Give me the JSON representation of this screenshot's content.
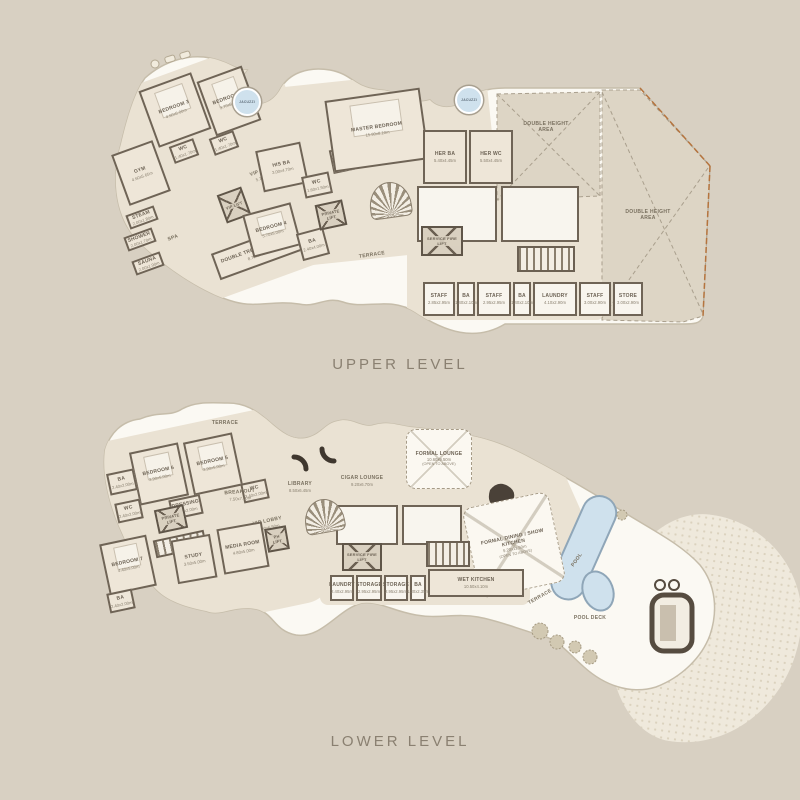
{
  "colors": {
    "background": "#d8d0c2",
    "plan_fill": "#fbf9f3",
    "floor_fill": "#eae2d3",
    "wall": "#6f6456",
    "pool": "#cfe1ed",
    "accent_rust": "#b5743e",
    "label_text": "#6d6355"
  },
  "plans": {
    "upper": {
      "caption": "UPPER LEVEL",
      "rooms": [
        {
          "name": "room-bedroom-3",
          "kind": "bedroom",
          "label": "BEDROOM 3",
          "dims": "4.60x5.00m",
          "box": [
            62,
            32,
            56,
            60,
            -20
          ]
        },
        {
          "name": "room-bedroom-2",
          "kind": "bedroom",
          "label": "BEDROOM 2",
          "dims": "3.70x5.00m",
          "box": [
            120,
            24,
            48,
            58,
            -20
          ]
        },
        {
          "name": "room-wc-bedroom3",
          "kind": "room",
          "label": "WC",
          "dims": "1.40x1.70m",
          "box": [
            86,
            94,
            26,
            18,
            -20
          ]
        },
        {
          "name": "room-wc-bedroom2",
          "kind": "room",
          "label": "WC",
          "dims": "1.40x1.70m",
          "box": [
            126,
            86,
            26,
            18,
            -20
          ]
        },
        {
          "name": "room-gym",
          "kind": "room",
          "label": "GYM",
          "dims": "4.60x5.65m",
          "box": [
            34,
            98,
            44,
            54,
            -20
          ]
        },
        {
          "name": "area-vip-lobby",
          "kind": "area",
          "label": "VIP LOBBY",
          "dims": "5.10x6.50m",
          "box": [
            150,
            112,
            60,
            26,
            -20
          ]
        },
        {
          "name": "room-vip-lift",
          "kind": "lift",
          "label": "VIP LIFT",
          "box": [
            136,
            142,
            26,
            30,
            -20
          ]
        },
        {
          "name": "room-steam",
          "kind": "room",
          "label": "STEAM",
          "dims": "2.00x1.80m",
          "box": [
            42,
            162,
            30,
            15,
            -20
          ]
        },
        {
          "name": "room-shower",
          "kind": "room",
          "label": "SHOWER",
          "dims": "2.00x1.70m",
          "box": [
            40,
            184,
            30,
            15,
            -20
          ]
        },
        {
          "name": "area-spa",
          "kind": "area",
          "label": "SPA",
          "box": [
            76,
            182,
            24,
            16,
            -20
          ]
        },
        {
          "name": "room-sauna",
          "kind": "room",
          "label": "SAUNA",
          "dims": "2.00x1.90m",
          "box": [
            48,
            208,
            30,
            15,
            -20
          ]
        },
        {
          "name": "room-double-treatment",
          "kind": "room",
          "label": "DOUBLE TREATMENT ROOM",
          "dims": "8.70x5.30m",
          "box": [
            128,
            190,
            88,
            28,
            -20
          ]
        },
        {
          "name": "room-bedroom-4",
          "kind": "bedroom",
          "label": "BEDROOM 4",
          "dims": "5.70x5.00m",
          "box": [
            162,
            160,
            50,
            44,
            -15
          ]
        },
        {
          "name": "room-ba-bedroom4",
          "kind": "room",
          "label": "BA",
          "dims": "2.40x4.00m",
          "box": [
            214,
            182,
            28,
            28,
            -15
          ]
        },
        {
          "name": "room-his-ba",
          "kind": "room",
          "label": "HIS BA",
          "dims": "3.00x4.70m",
          "box": [
            174,
            98,
            46,
            42,
            -12
          ]
        },
        {
          "name": "room-wc-master",
          "kind": "room",
          "label": "WC",
          "dims": "1.60x1.50m",
          "box": [
            218,
            126,
            28,
            22,
            -12
          ]
        },
        {
          "name": "room-safe",
          "kind": "room",
          "label": "SAFE",
          "dims": "1.20x1.90m",
          "box": [
            246,
            100,
            22,
            24,
            -12
          ]
        },
        {
          "name": "room-master-bedroom",
          "kind": "bedroom",
          "label": "MASTER BEDROOM",
          "dims": "15.90x8.10m",
          "box": [
            244,
            46,
            96,
            72,
            -8
          ]
        },
        {
          "name": "room-her-ba",
          "kind": "room",
          "label": "HER BA",
          "dims": "5.40x4.45m",
          "box": [
            338,
            82,
            44,
            54,
            0
          ]
        },
        {
          "name": "room-her-wc",
          "kind": "room",
          "label": "HER WC",
          "dims": "5.50x4.45m",
          "box": [
            384,
            82,
            44,
            54,
            0
          ]
        },
        {
          "name": "room-private-lift",
          "kind": "lift",
          "label": "PRIVATE LIFT",
          "box": [
            232,
            154,
            28,
            26,
            -12
          ]
        },
        {
          "name": "area-terrace",
          "kind": "area",
          "label": "TERRACE",
          "box": [
            252,
            200,
            70,
            14,
            -8
          ]
        },
        {
          "name": "jacuzzi-left",
          "kind": "jacuzzi",
          "label": "JACUZZI",
          "box": [
            148,
            40,
            28,
            28,
            0
          ]
        },
        {
          "name": "jacuzzi-right",
          "kind": "jacuzzi",
          "label": "JACUZZI",
          "box": [
            370,
            38,
            28,
            28,
            0
          ]
        },
        {
          "name": "room-service-block-1",
          "kind": "roomw",
          "box": [
            332,
            138,
            80,
            56,
            0
          ]
        },
        {
          "name": "room-service-block-2",
          "kind": "roomw",
          "box": [
            416,
            138,
            78,
            56,
            0
          ]
        },
        {
          "name": "stairs-service",
          "kind": "stairs",
          "box": [
            432,
            198,
            58,
            26,
            0
          ]
        },
        {
          "name": "room-service-fire-lift",
          "kind": "lift",
          "label": "SERVICE FIRE LIFT",
          "box": [
            336,
            178,
            42,
            30,
            0
          ]
        },
        {
          "name": "stairs-main-spiral",
          "kind": "spiral",
          "box": [
            284,
            134,
            42,
            36,
            -8
          ]
        },
        {
          "name": "room-staff-1",
          "kind": "roomw",
          "label": "STAFF",
          "dims": "2.85x2.95m",
          "box": [
            338,
            234,
            32,
            34,
            0
          ]
        },
        {
          "name": "room-ba-staff-1",
          "kind": "roomw",
          "label": "BA",
          "dims": "1.40x2.10m",
          "box": [
            372,
            234,
            18,
            34,
            0
          ]
        },
        {
          "name": "room-staff-2",
          "kind": "roomw",
          "label": "STAFF",
          "dims": "2.95x2.95m",
          "box": [
            392,
            234,
            34,
            34,
            0
          ]
        },
        {
          "name": "room-ba-staff-2",
          "kind": "roomw",
          "label": "BA",
          "dims": "1.40x2.10m",
          "box": [
            428,
            234,
            18,
            34,
            0
          ]
        },
        {
          "name": "room-laundry",
          "kind": "roomw",
          "label": "LAUNDRY",
          "dims": "4.10x2.90m",
          "box": [
            448,
            234,
            44,
            34,
            0
          ]
        },
        {
          "name": "room-staff-3",
          "kind": "roomw",
          "label": "STAFF",
          "dims": "3.00x2.90m",
          "box": [
            494,
            234,
            32,
            34,
            0
          ]
        },
        {
          "name": "room-store",
          "kind": "roomw",
          "label": "STORE",
          "dims": "3.00x2.90m",
          "box": [
            528,
            234,
            30,
            34,
            0
          ]
        },
        {
          "name": "area-double-height-top",
          "kind": "area",
          "label": "DOUBLE HEIGHT AREA",
          "box": [
            430,
            70,
            62,
            18,
            0
          ]
        },
        {
          "name": "area-double-height-right",
          "kind": "area",
          "label": "DOUBLE HEIGHT AREA",
          "box": [
            535,
            158,
            56,
            18,
            0
          ]
        }
      ]
    },
    "lower": {
      "caption": "LOWER LEVEL",
      "rooms": [
        {
          "name": "area-terrace-top",
          "kind": "area",
          "label": "TERRACE",
          "box": [
            130,
            22,
            50,
            12,
            0
          ]
        },
        {
          "name": "room-bedroom-6",
          "kind": "bedroom",
          "label": "BEDROOM 6",
          "dims": "3.90x5.00m",
          "box": [
            64,
            52,
            50,
            54,
            -12
          ]
        },
        {
          "name": "room-bedroom-5",
          "kind": "bedroom",
          "label": "BEDROOM 5",
          "dims": "3.90x5.00m",
          "box": [
            118,
            42,
            50,
            54,
            -12
          ]
        },
        {
          "name": "room-ba-bedroom6",
          "kind": "room",
          "label": "BA",
          "dims": "2.40x2.00m",
          "box": [
            38,
            76,
            28,
            22,
            -12
          ]
        },
        {
          "name": "room-wc-bedroom6",
          "kind": "room",
          "label": "WC",
          "dims": "2.40x2.00m",
          "box": [
            46,
            106,
            26,
            20,
            -12
          ]
        },
        {
          "name": "room-dressing",
          "kind": "room",
          "label": "DRESSING",
          "dims": "2.00x2.00m",
          "box": [
            100,
            102,
            32,
            20,
            -12
          ]
        },
        {
          "name": "room-wc-bedroom5",
          "kind": "room",
          "label": "WC",
          "dims": "2.40x2.00m",
          "box": [
            172,
            86,
            26,
            20,
            -12
          ]
        },
        {
          "name": "area-vip-lobby-lower",
          "kind": "area",
          "label": "VIP LOBBY",
          "dims": "5.00x6.50m",
          "box": [
            170,
            118,
            56,
            22,
            -12
          ]
        },
        {
          "name": "room-private-lift-lower",
          "kind": "lift",
          "label": "PRIVATE LIFT",
          "box": [
            86,
            112,
            30,
            24,
            -12
          ]
        },
        {
          "name": "stairs-vip",
          "kind": "stairs",
          "box": [
            84,
            140,
            52,
            18,
            -12
          ]
        },
        {
          "name": "room-bedroom-7",
          "kind": "bedroom",
          "label": "BEDROOM 7",
          "dims": "4.40x5.00m",
          "box": [
            34,
            144,
            48,
            52,
            -12
          ]
        },
        {
          "name": "room-ba-bedroom7",
          "kind": "room",
          "label": "BA",
          "dims": "2.40x2.00m",
          "box": [
            38,
            196,
            26,
            20,
            -12
          ]
        },
        {
          "name": "room-study",
          "kind": "room",
          "label": "STUDY",
          "dims": "3.50x5.00m",
          "box": [
            104,
            142,
            40,
            44,
            -10
          ]
        },
        {
          "name": "room-media",
          "kind": "room",
          "label": "MEDIA ROOM",
          "dims": "4.80x5.00m",
          "box": [
            150,
            130,
            46,
            46,
            -10
          ]
        },
        {
          "name": "room-ph-lift",
          "kind": "lift",
          "label": "PH LIFT",
          "box": [
            196,
            132,
            22,
            24,
            -10
          ]
        },
        {
          "name": "area-breakout",
          "kind": "area",
          "label": "BREAKOUT",
          "dims": "7.50x7.00m",
          "box": [
            142,
            90,
            56,
            20,
            -5
          ]
        },
        {
          "name": "area-library",
          "kind": "area",
          "label": "LIBRARY",
          "dims": "8.50x6.45m",
          "box": [
            204,
            82,
            52,
            20,
            0
          ]
        },
        {
          "name": "area-cigar-lounge",
          "kind": "area",
          "label": "CIGAR LOUNGE",
          "dims": "9.20x6.70m",
          "box": [
            264,
            76,
            56,
            20,
            0
          ]
        },
        {
          "name": "room-formal-lounge",
          "kind": "open",
          "label": "FORMAL LOUNGE",
          "dims": "10.60x9.50m",
          "sub": "(OPEN TO ABOVE)",
          "box": [
            336,
            34,
            66,
            60,
            0
          ]
        },
        {
          "name": "area-formal-dining",
          "kind": "open",
          "label": "FORMAL DINING / SHOW KITCHEN",
          "dims": "9.20x11.50m",
          "sub": "(OPEN TO ABOVE)",
          "box": [
            400,
            104,
            88,
            92,
            -12
          ]
        },
        {
          "name": "room-pr",
          "kind": "room",
          "label": "PR",
          "dims": "1.80x1.60m",
          "box": [
            368,
            110,
            20,
            18,
            0
          ]
        },
        {
          "name": "room-service-block-lower-1",
          "kind": "roomw",
          "box": [
            266,
            110,
            62,
            40,
            0
          ]
        },
        {
          "name": "room-service-block-lower-2",
          "kind": "roomw",
          "box": [
            332,
            110,
            60,
            40,
            0
          ]
        },
        {
          "name": "room-service-fire-lift-lower",
          "kind": "lift",
          "label": "SERVICE FIRE LIFT",
          "box": [
            272,
            148,
            40,
            28,
            0
          ]
        },
        {
          "name": "stairs-service-lower",
          "kind": "stairs",
          "box": [
            356,
            146,
            44,
            26,
            0
          ]
        },
        {
          "name": "stairs-spiral-lower",
          "kind": "spiral",
          "box": [
            234,
            104,
            40,
            34,
            -10
          ]
        },
        {
          "name": "room-laundry-lower",
          "kind": "roomw",
          "label": "LAUNDRY",
          "dims": "2.40x2.95m",
          "box": [
            260,
            180,
            24,
            26,
            0
          ]
        },
        {
          "name": "room-storage-1",
          "kind": "roomw",
          "label": "STORAGE",
          "dims": "2.95x2.95m",
          "box": [
            286,
            180,
            26,
            26,
            0
          ]
        },
        {
          "name": "room-storage-2",
          "kind": "roomw",
          "label": "STORAGE",
          "dims": "2.95x2.95m",
          "box": [
            314,
            180,
            24,
            26,
            0
          ]
        },
        {
          "name": "room-ba-staff-lower",
          "kind": "roomw",
          "label": "BA",
          "dims": "1.30x2.35m",
          "box": [
            340,
            180,
            16,
            26,
            0
          ]
        },
        {
          "name": "room-wet-kitchen",
          "kind": "room",
          "label": "WET KITCHEN",
          "dims": "10.50x4.10m",
          "box": [
            358,
            174,
            96,
            28,
            0
          ]
        },
        {
          "name": "area-terrace-right",
          "kind": "area",
          "label": "TERRACE",
          "box": [
            448,
            196,
            44,
            12,
            -30
          ]
        },
        {
          "name": "area-pool",
          "kind": "area",
          "label": "POOL",
          "box": [
            492,
            160,
            30,
            10,
            -55
          ]
        },
        {
          "name": "area-pool-deck",
          "kind": "area",
          "label": "POOL DECK",
          "box": [
            498,
            218,
            44,
            10,
            0
          ]
        }
      ]
    }
  }
}
